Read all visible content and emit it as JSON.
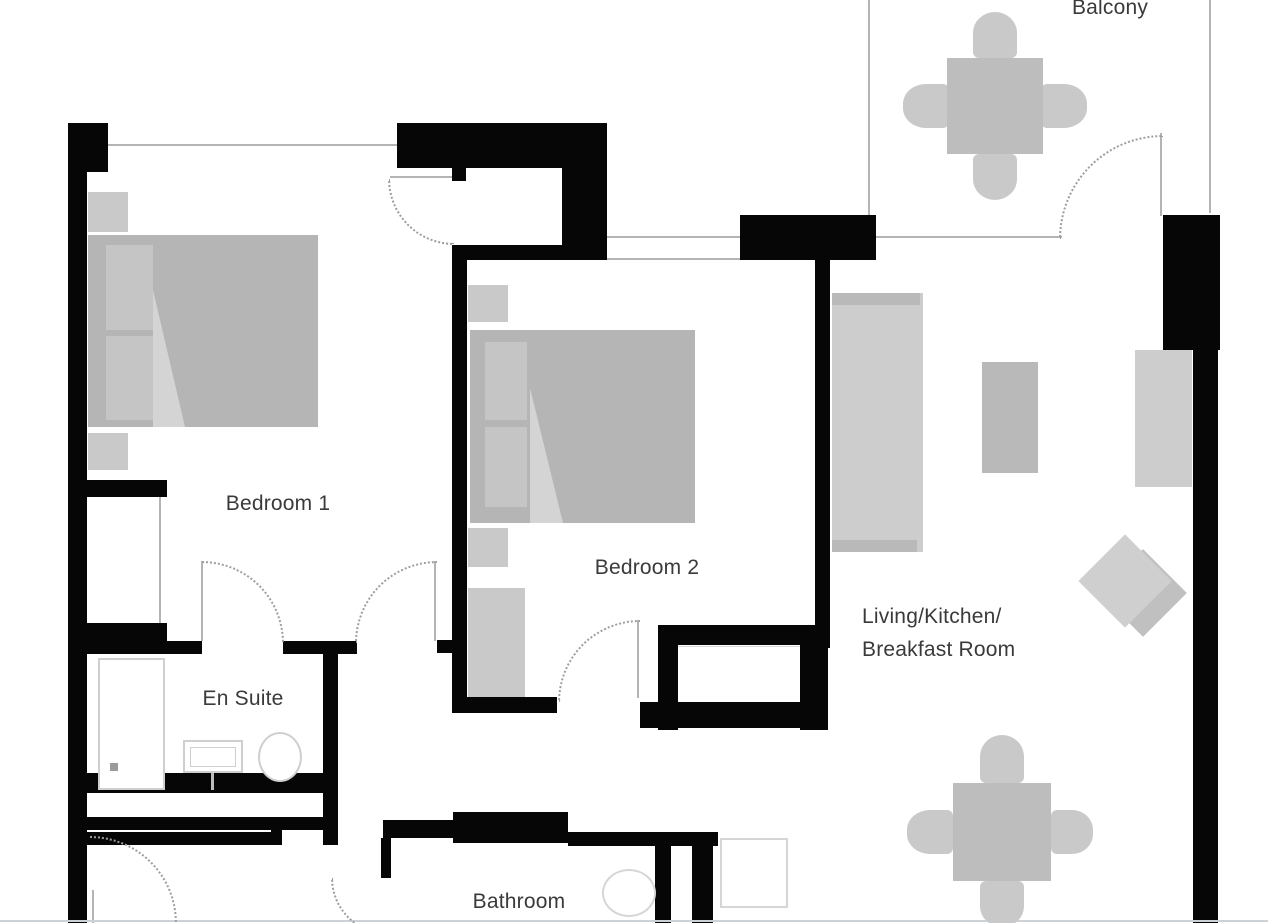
{
  "plan_title": "Two-bedroom apartment floor plan",
  "rooms": [
    {
      "id": "bedroom-1",
      "label": "Bedroom 1"
    },
    {
      "id": "bedroom-2",
      "label": "Bedroom 2"
    },
    {
      "id": "en-suite",
      "label": "En Suite"
    },
    {
      "id": "bathroom",
      "label": "Bathroom"
    },
    {
      "id": "living",
      "label_line1": "Living/Kitchen/",
      "label_line2": "Breakfast Room"
    },
    {
      "id": "balcony",
      "label": "Balcony"
    }
  ],
  "furniture": [
    {
      "name": "double-bed-bedroom-1"
    },
    {
      "name": "double-bed-bedroom-2"
    },
    {
      "name": "nightstands"
    },
    {
      "name": "wardrobe-bedroom-2"
    },
    {
      "name": "shower-enclosure-en-suite"
    },
    {
      "name": "washbasin-en-suite"
    },
    {
      "name": "toilet-en-suite"
    },
    {
      "name": "toilet-bathroom"
    },
    {
      "name": "cupboard-unit"
    },
    {
      "name": "sofa"
    },
    {
      "name": "coffee-table"
    },
    {
      "name": "tv-sideboard"
    },
    {
      "name": "lounge-chair-diamond"
    },
    {
      "name": "dining-table-4-chairs-living"
    },
    {
      "name": "dining-table-4-chairs-balcony"
    }
  ],
  "doors": [
    {
      "name": "entry-door"
    },
    {
      "name": "en-suite-door"
    },
    {
      "name": "bedroom-1-door"
    },
    {
      "name": "bedroom-2-door"
    },
    {
      "name": "balcony-door"
    },
    {
      "name": "bathroom-door"
    },
    {
      "name": "hall-door"
    }
  ],
  "colors": {
    "wall": "#060606",
    "thin-line": "#b4b4b4",
    "arc": "#9e9e9e",
    "furniture-dark": "#b5b5b5",
    "furniture-mid": "#bdbdbd",
    "furniture-light": "#cdcdcd",
    "text": "#3a3a3a",
    "background": "#ffffff"
  }
}
